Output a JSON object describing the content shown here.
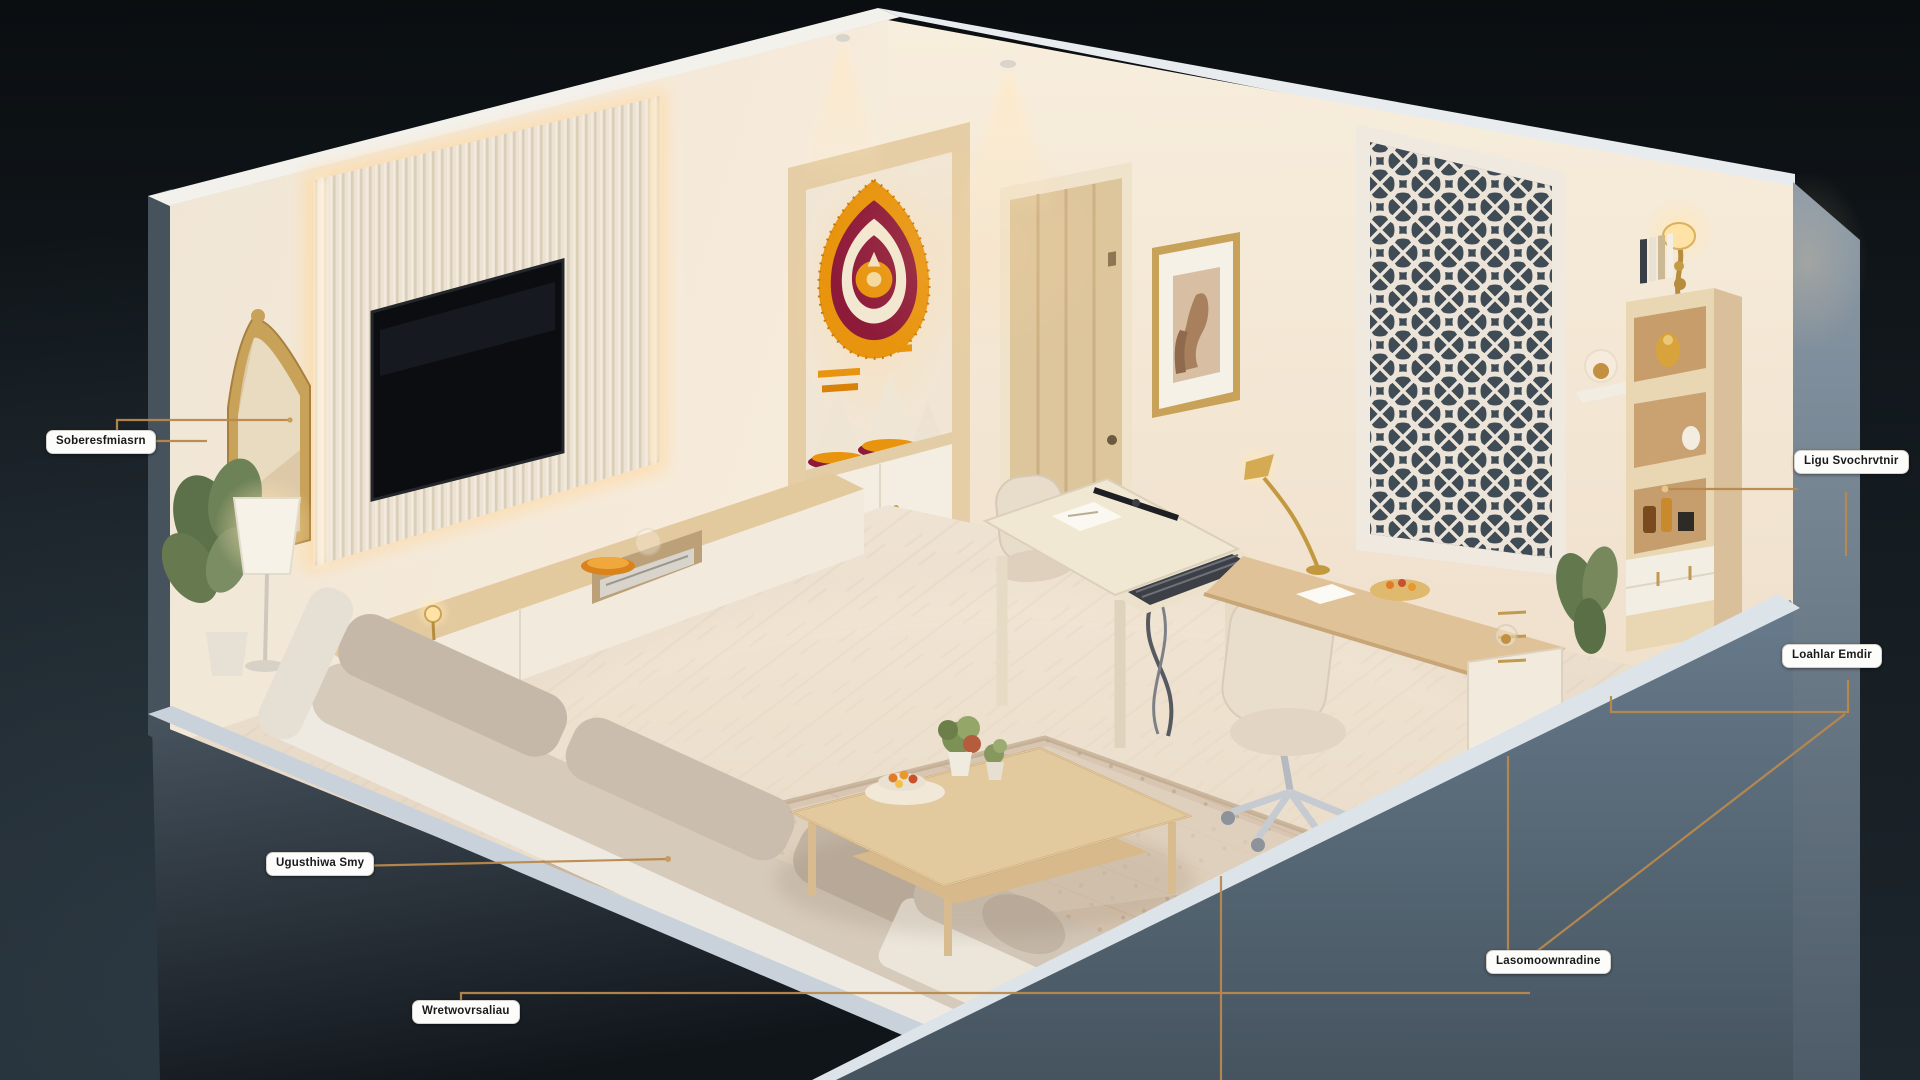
{
  "scene": {
    "title": "Annotated isometric living room cutaway render"
  },
  "labels": [
    {
      "text": "Soberesfmiasrn"
    },
    {
      "text": "Ligu Svochrvtnir"
    },
    {
      "text": "Loahlar Emdir"
    },
    {
      "text": "Ugusthiwa Smy"
    },
    {
      "text": "Wretwovrsaliau"
    },
    {
      "text": "Lasomoownradine"
    }
  ],
  "palette": {
    "background": "#10161b",
    "accent_gold_line": "#b9894e",
    "label_bg": "#fcfcfb",
    "label_text": "#191919",
    "wall_cream": "#f4e9d8",
    "front_wall_blue_gray": "#5f7181",
    "plinth_dark": "#39444e",
    "wood_light": "#dfc196",
    "marigold_orange": "#e8940e",
    "garland_maroon": "#8e1a3a",
    "floor_beige": "#e9dccb",
    "tv_black": "#0b0d10"
  }
}
